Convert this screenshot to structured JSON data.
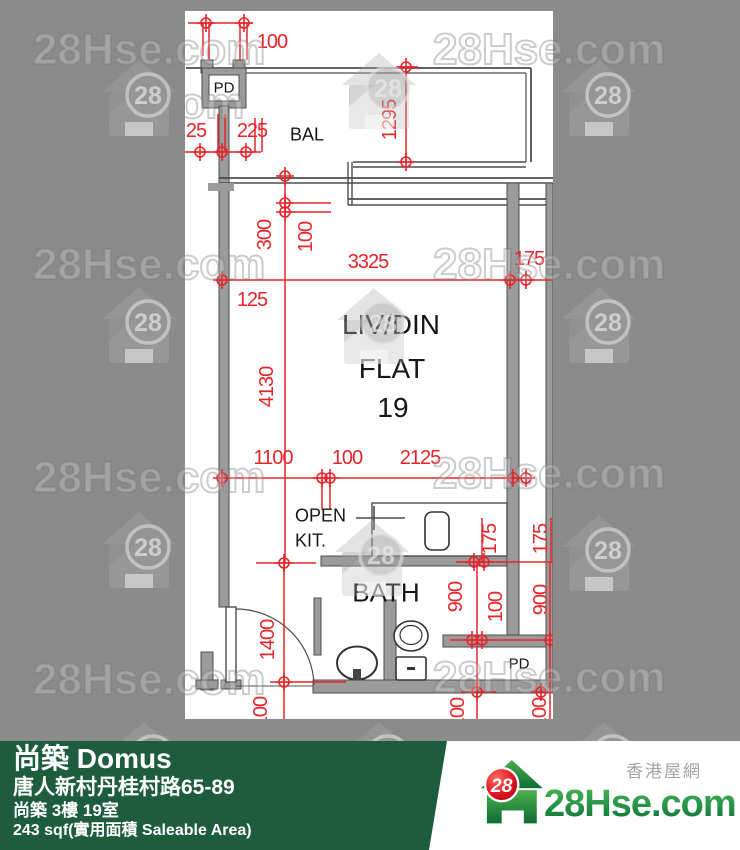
{
  "watermark": {
    "text": "28Hse.com",
    "badge": "28"
  },
  "plan": {
    "labels": {
      "pd_top": "PD",
      "bal": "BAL",
      "livdin": "LIV/DIN",
      "flat": "FLAT",
      "flat_no": "19",
      "open": "OPEN",
      "kit": "KIT.",
      "bath": "BATH",
      "pd_bottom": "PD"
    },
    "dims": [
      "100",
      "25",
      "225",
      "1295",
      "300",
      "100",
      "3325",
      "125",
      "4130",
      "175",
      "1100",
      "100",
      "2125",
      "175",
      "175",
      "900",
      "100",
      "900",
      "1400",
      "100",
      "100",
      "100"
    ]
  },
  "footer": {
    "title": "尚築 Domus",
    "address": "唐人新村丹桂村路65-89",
    "unit": "尚築 3樓 19室",
    "area": "243 sqf(實用面積 Saleable Area)",
    "brand": {
      "site_name_cn": "香港屋網",
      "logo_text": "28Hse.com",
      "logo_badge": "28"
    }
  },
  "colors": {
    "background": "#8b8b8b",
    "plan_bg": "#ffffff",
    "dim_red": "#e8252a",
    "wall_gray": "#9b9b9b",
    "line_dark": "#4d4d4d",
    "bar_green": "#1e5c3e",
    "logo_green": "#0a6b33",
    "badge_red": "#e11422"
  }
}
